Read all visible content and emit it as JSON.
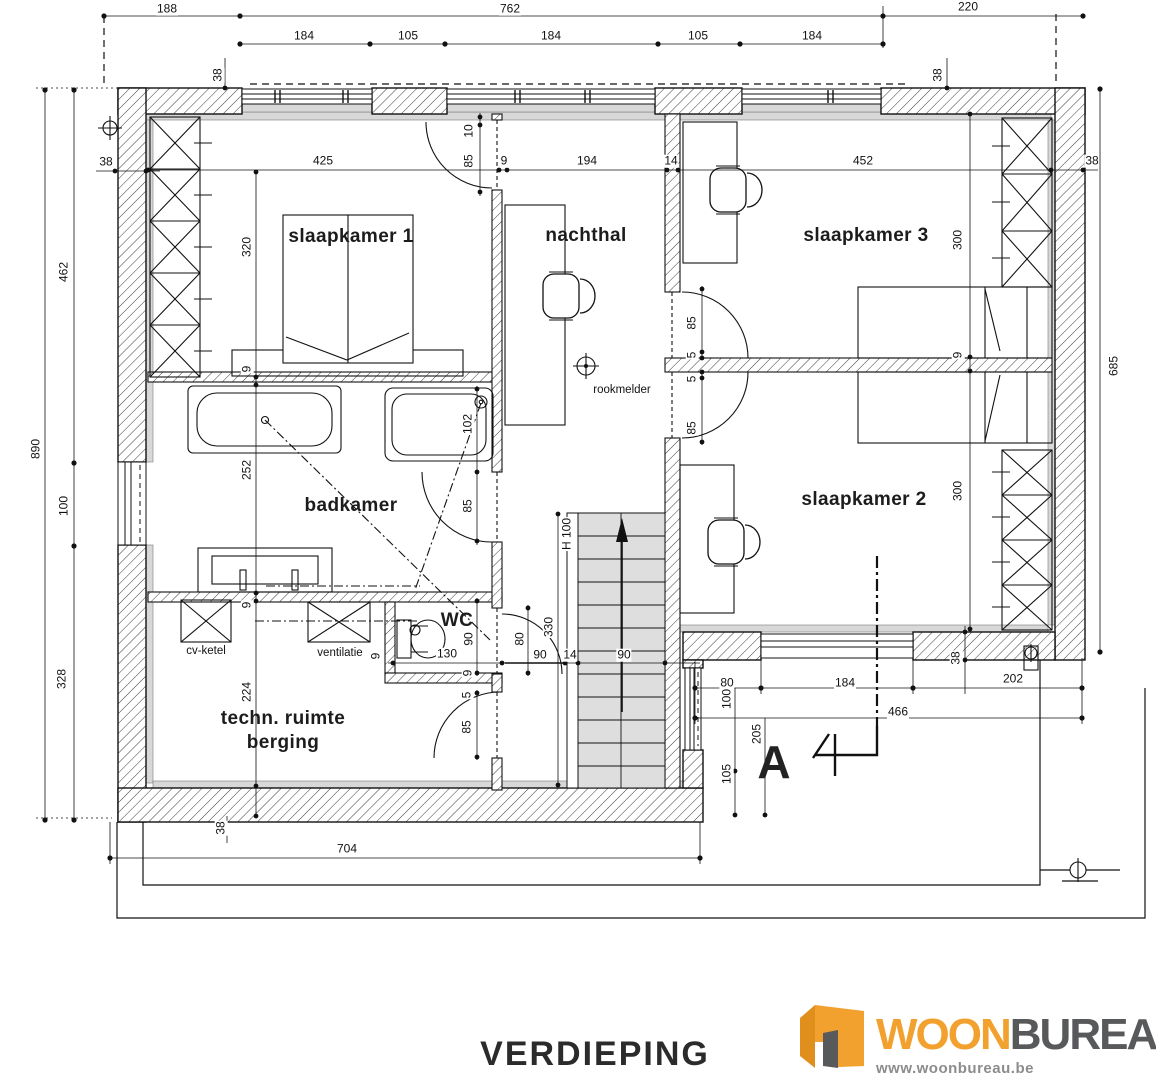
{
  "page": {
    "title": "VERDIEPING"
  },
  "logo": {
    "woon": "WOON",
    "bureau": "BUREAU",
    "url": "www.woonbureau.be",
    "orange": "#F2A12F",
    "dark_gray": "#58595B"
  },
  "plan": {
    "rooms": [
      {
        "name": "slaapkamer-1",
        "label": "slaapkamer 1",
        "x": 351,
        "y": 237
      },
      {
        "name": "nachthal",
        "label": "nachthal",
        "x": 586,
        "y": 236
      },
      {
        "name": "slaapkamer-3",
        "label": "slaapkamer 3",
        "x": 866,
        "y": 236
      },
      {
        "name": "badkamer",
        "label": "badkamer",
        "x": 351,
        "y": 506
      },
      {
        "name": "slaapkamer-2",
        "label": "slaapkamer 2",
        "x": 864,
        "y": 500
      },
      {
        "name": "wc",
        "label": "WC",
        "x": 457,
        "y": 621
      },
      {
        "name": "techn-ruimte",
        "label": "techn. ruimte",
        "x": 283,
        "y": 719
      },
      {
        "name": "berging",
        "label": "berging",
        "x": 283,
        "y": 743
      }
    ],
    "fixture_labels": [
      {
        "name": "cv-ketel",
        "label": "cv-ketel",
        "x": 206,
        "y": 651
      },
      {
        "name": "ventilatie",
        "label": "ventilatie",
        "x": 340,
        "y": 653
      },
      {
        "name": "rookmelder",
        "label": "rookmelder",
        "x": 622,
        "y": 390
      }
    ],
    "section_marker": {
      "label": "A",
      "x": 774,
      "y": 762
    },
    "dimensions": [
      {
        "text": "188",
        "x": 167,
        "y": 9
      },
      {
        "text": "762",
        "x": 510,
        "y": 9
      },
      {
        "text": "220",
        "x": 968,
        "y": 7
      },
      {
        "text": "184",
        "x": 304,
        "y": 36
      },
      {
        "text": "105",
        "x": 408,
        "y": 36
      },
      {
        "text": "184",
        "x": 551,
        "y": 36
      },
      {
        "text": "105",
        "x": 698,
        "y": 36
      },
      {
        "text": "184",
        "x": 812,
        "y": 36
      },
      {
        "text": "38",
        "x": 218,
        "y": 75,
        "rot": true
      },
      {
        "text": "38",
        "x": 938,
        "y": 75,
        "rot": true
      },
      {
        "text": "38",
        "x": 106,
        "y": 162
      },
      {
        "text": "462",
        "x": 64,
        "y": 272,
        "rot": true
      },
      {
        "text": "890",
        "x": 36,
        "y": 449,
        "rot": true
      },
      {
        "text": "100",
        "x": 64,
        "y": 506,
        "rot": true
      },
      {
        "text": "328",
        "x": 62,
        "y": 679,
        "rot": true
      },
      {
        "text": "685",
        "x": 1114,
        "y": 366,
        "rot": true
      },
      {
        "text": "425",
        "x": 323,
        "y": 161
      },
      {
        "text": "9",
        "x": 504,
        "y": 161
      },
      {
        "text": "194",
        "x": 587,
        "y": 161
      },
      {
        "text": "14",
        "x": 671,
        "y": 161
      },
      {
        "text": "452",
        "x": 863,
        "y": 161
      },
      {
        "text": "38",
        "x": 1092,
        "y": 161
      },
      {
        "text": "10",
        "x": 469,
        "y": 131,
        "rot": true
      },
      {
        "text": "85",
        "x": 469,
        "y": 161,
        "rot": true
      },
      {
        "text": "320",
        "x": 247,
        "y": 247,
        "rot": true
      },
      {
        "text": "9",
        "x": 247,
        "y": 369,
        "rot": true
      },
      {
        "text": "252",
        "x": 247,
        "y": 470,
        "rot": true
      },
      {
        "text": "9",
        "x": 247,
        "y": 605,
        "rot": true
      },
      {
        "text": "224",
        "x": 247,
        "y": 692,
        "rot": true
      },
      {
        "text": "102",
        "x": 468,
        "y": 424,
        "rot": true
      },
      {
        "text": "85",
        "x": 468,
        "y": 506,
        "rot": true
      },
      {
        "text": "90",
        "x": 469,
        "y": 639,
        "rot": true
      },
      {
        "text": "130",
        "x": 447,
        "y": 654
      },
      {
        "text": "9",
        "x": 468,
        "y": 673,
        "rot": true
      },
      {
        "text": "9",
        "x": 376,
        "y": 656,
        "rot": true
      },
      {
        "text": "90",
        "x": 540,
        "y": 655
      },
      {
        "text": "14",
        "x": 570,
        "y": 655
      },
      {
        "text": "90",
        "x": 624,
        "y": 655
      },
      {
        "text": "80",
        "x": 520,
        "y": 639,
        "rot": true
      },
      {
        "text": "330",
        "x": 549,
        "y": 627,
        "rot": true
      },
      {
        "text": "H 100",
        "x": 567,
        "y": 534,
        "rot": true
      },
      {
        "text": "300",
        "x": 958,
        "y": 240,
        "rot": true
      },
      {
        "text": "9",
        "x": 958,
        "y": 355,
        "rot": true
      },
      {
        "text": "300",
        "x": 958,
        "y": 491,
        "rot": true
      },
      {
        "text": "38",
        "x": 956,
        "y": 658,
        "rot": true
      },
      {
        "text": "85",
        "x": 692,
        "y": 323,
        "rot": true
      },
      {
        "text": "5",
        "x": 692,
        "y": 355,
        "rot": true
      },
      {
        "text": "5",
        "x": 692,
        "y": 379,
        "rot": true
      },
      {
        "text": "85",
        "x": 692,
        "y": 428,
        "rot": true
      },
      {
        "text": "5",
        "x": 467,
        "y": 695,
        "rot": true
      },
      {
        "text": "85",
        "x": 467,
        "y": 727,
        "rot": true
      },
      {
        "text": "80",
        "x": 727,
        "y": 683
      },
      {
        "text": "184",
        "x": 845,
        "y": 683
      },
      {
        "text": "202",
        "x": 1013,
        "y": 679
      },
      {
        "text": "100",
        "x": 727,
        "y": 699,
        "rot": true
      },
      {
        "text": "466",
        "x": 898,
        "y": 712
      },
      {
        "text": "205",
        "x": 757,
        "y": 734,
        "rot": true
      },
      {
        "text": "105",
        "x": 727,
        "y": 774,
        "rot": true
      },
      {
        "text": "38",
        "x": 221,
        "y": 828,
        "rot": true
      },
      {
        "text": "704",
        "x": 347,
        "y": 849
      }
    ]
  }
}
